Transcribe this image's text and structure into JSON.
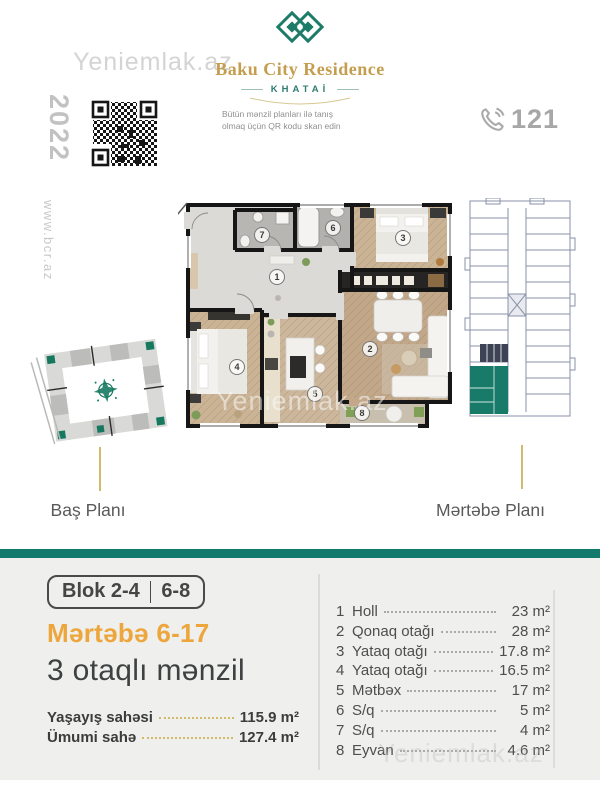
{
  "watermark": "Yeniemlak.az",
  "header": {
    "brand": "Baku City Residence",
    "district": "KHATAİ",
    "year": "2022",
    "qr_caption": [
      "Bütün mənzil planları ilə tanış",
      "olmaq üçün QR kodu skan edin"
    ],
    "phone": "121",
    "website": "www.bcr.az"
  },
  "plans": {
    "site_plan_label": "Baş Planı",
    "floor_plan_label": "Mərtəbə Planı"
  },
  "floor_plan_numbers": [
    "1",
    "2",
    "3",
    "4",
    "5",
    "6",
    "7",
    "8"
  ],
  "offer": {
    "block_left": "Blok 2-4",
    "block_right": "6-8",
    "floors": "Mərtəbə 6-17",
    "title": "3 otaqlı mənzil",
    "areas": [
      {
        "label": "Yaşayış sahəsi",
        "value": "115.9 m²"
      },
      {
        "label": "Ümumi  sahə",
        "value": "127.4 m²"
      }
    ]
  },
  "rooms": [
    {
      "num": "1",
      "name": "Holl",
      "area": "23 m²"
    },
    {
      "num": "2",
      "name": "Qonaq otağı",
      "area": "28 m²"
    },
    {
      "num": "3",
      "name": "Yataq otağı",
      "area": "17.8 m²"
    },
    {
      "num": "4",
      "name": "Yataq otağı",
      "area": "16.5 m²"
    },
    {
      "num": "5",
      "name": "Mətbəx",
      "area": "17 m²"
    },
    {
      "num": "6",
      "name": "S/q",
      "area": "5 m²"
    },
    {
      "num": "7",
      "name": "S/q",
      "area": "4 m²"
    },
    {
      "num": "8",
      "name": "Eyvan",
      "area": "4.6 m²"
    }
  ],
  "colors": {
    "teal": "#117a6d",
    "gold": "#eda63c",
    "brand_gold": "#c49e4e"
  }
}
